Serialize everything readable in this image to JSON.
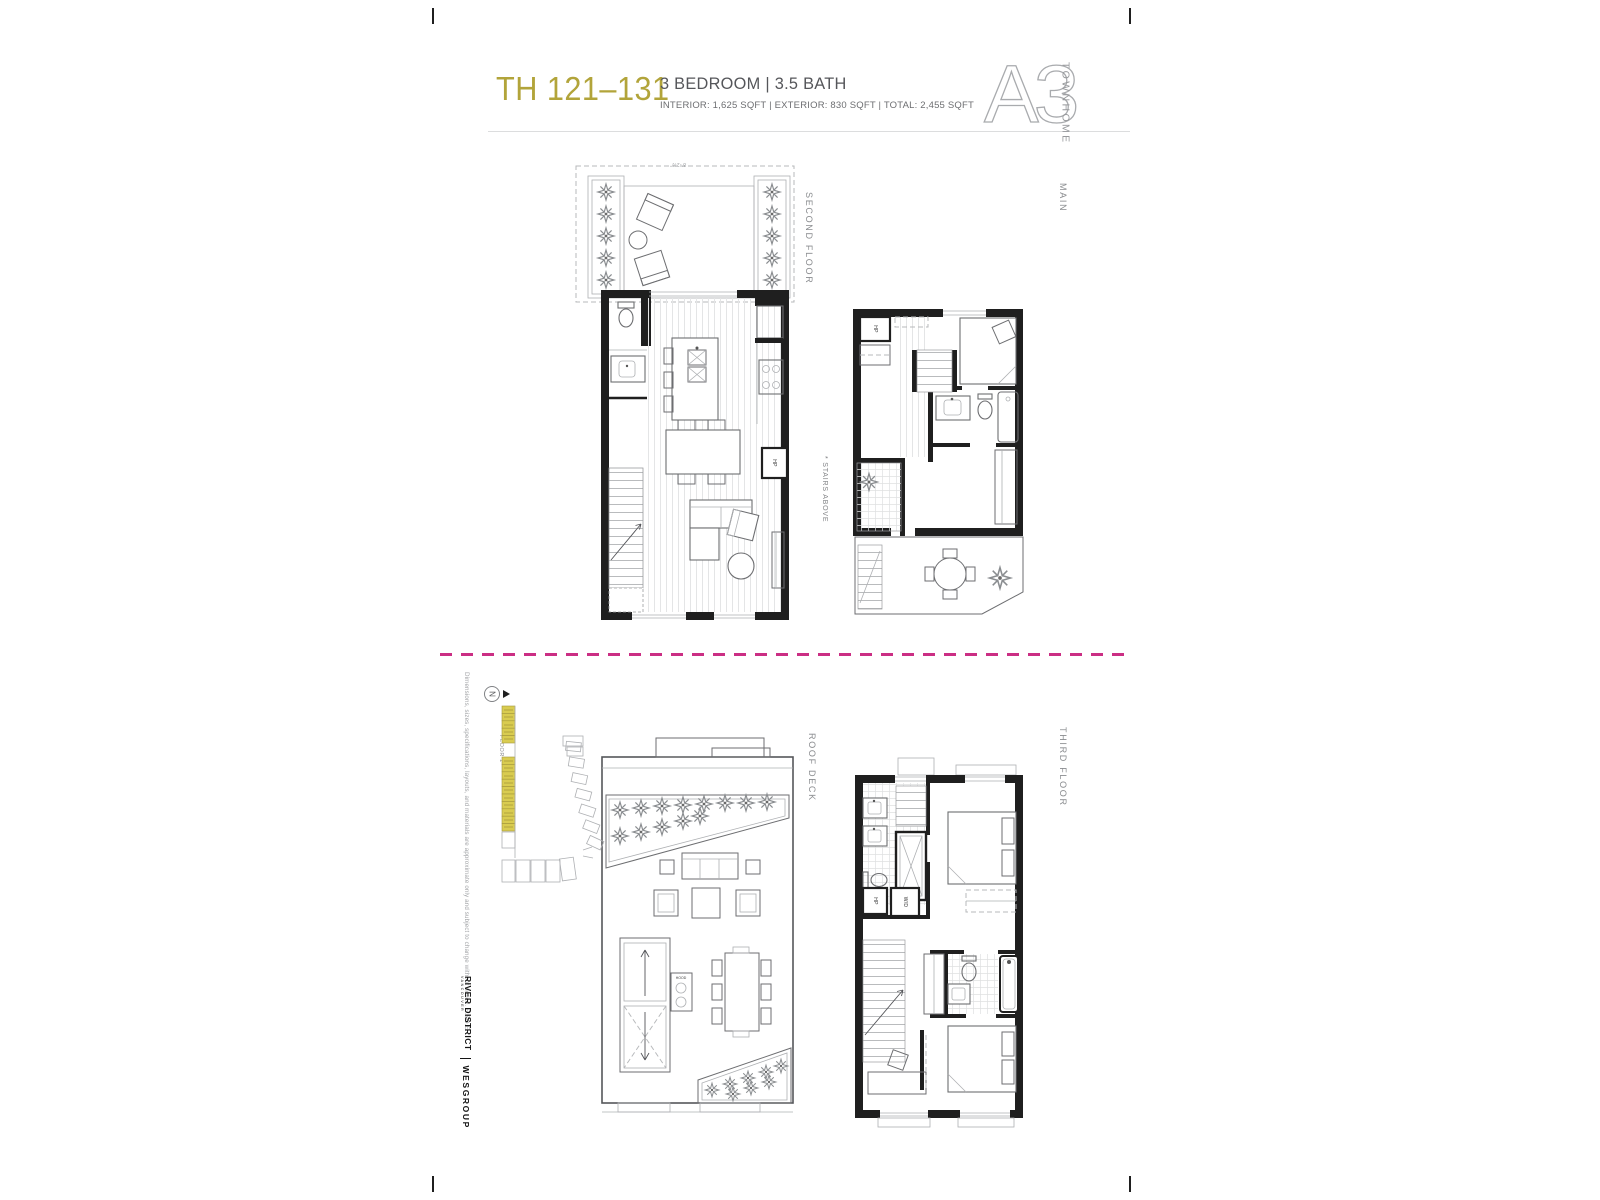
{
  "header": {
    "unit_range": "TH 121–131",
    "spec": "3 BEDROOM | 3.5 BATH",
    "areas": "INTERIOR: 1,625 SQFT  |  EXTERIOR: 830 SQFT  |  TOTAL: 2,455 SQFT",
    "plan_code": "A3",
    "plan_type": "TOWNHOME"
  },
  "floor_labels": {
    "second": "SECOND FLOOR",
    "main": "MAIN",
    "roof": "ROOF DECK",
    "third": "THIRD FLOOR"
  },
  "annotations": {
    "stairs_note": "* STAIRS ABOVE",
    "terrace_dim": "8'-2½\"",
    "key_floor": "FLOOR 1",
    "north": "N"
  },
  "fixtures": {
    "hp": "HP",
    "wd": "W/D",
    "hood": "HOOD"
  },
  "footer": {
    "disclaimer": "Dimensions, sizes, specifications, layouts, and materials are approximate only and subject to change without notice. E.&O.E.",
    "brand_primary": "RIVER DISTRICT",
    "brand_primary_sub": "VANCOUVER",
    "brand_secondary": "WESGROUP"
  },
  "colors": {
    "accent": "#b2a43a",
    "divider": "#cb2e84",
    "keyplan_highlight": "#d9cc50",
    "wall": "#1f1f1f"
  }
}
